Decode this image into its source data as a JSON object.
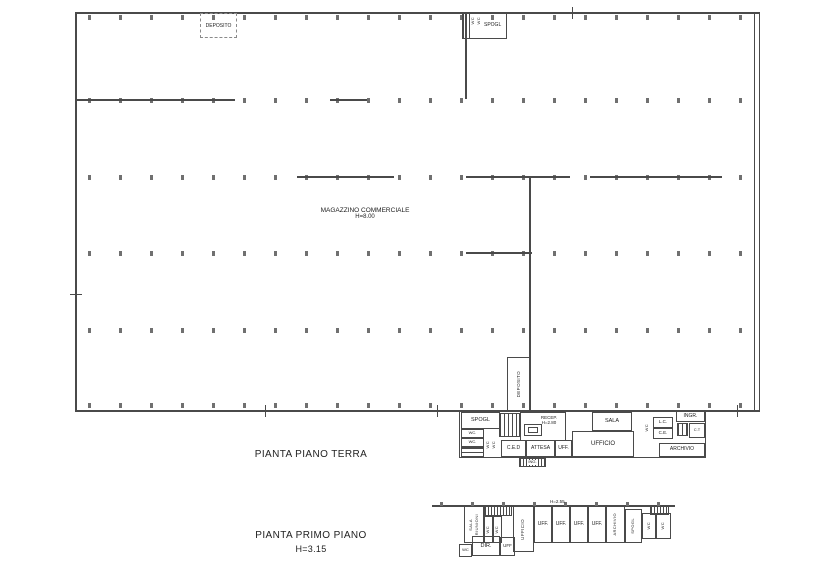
{
  "ground_floor": {
    "title": "PIANTA PIANO TERRA",
    "warehouse": {
      "name": "MAGAZZINO COMMERCIALE",
      "height": "H=8.00",
      "deposito_top": "DEPOSITO",
      "spogl_top": "SPOGL",
      "wc_top_a": "WC",
      "wc_top_b": "WC",
      "deposito_bottom": "DEPOSITO"
    },
    "offices": {
      "spogl": "SPOGL",
      "wc1": "WC.",
      "wc2": "WC.",
      "wc3": "WC",
      "wc4": "WC",
      "recep": "RECEP.",
      "recep_height": "H=2.80",
      "ced": "C.E.D",
      "attesa": "ATTESA",
      "ing": "ING.",
      "uff": "UFF.",
      "ufficio": "UFFICIO",
      "sala": "SALA",
      "wc5": "WC",
      "lc": "L.C.",
      "ce": "C.E.",
      "ingr": "INGR.",
      "ct": "C.T",
      "archivio": "ARCHIVIO"
    }
  },
  "first_floor": {
    "title": "PIANTA PRIMO PIANO",
    "height": "H=3.15",
    "dim": "H=2.55",
    "rooms": {
      "sala": "SALA",
      "riunioni": "RIUNIONI",
      "wc1": "WC",
      "wc2": "WC",
      "ufficio": "UFFICIO",
      "uff1": "UFF.",
      "uff2": "UFF.",
      "uff3": "UFF.",
      "uff4": "UFF.",
      "archivio": "ARCHIVIO",
      "spogl": "SPOGL",
      "wc3": "WC",
      "wc4": "WC",
      "wc5": "WC",
      "dir": "DIR.",
      "uff5": "UFF"
    }
  },
  "colors": {
    "wall": "#4a4a4a",
    "tick": "#707070",
    "text": "#1c1c1c"
  }
}
